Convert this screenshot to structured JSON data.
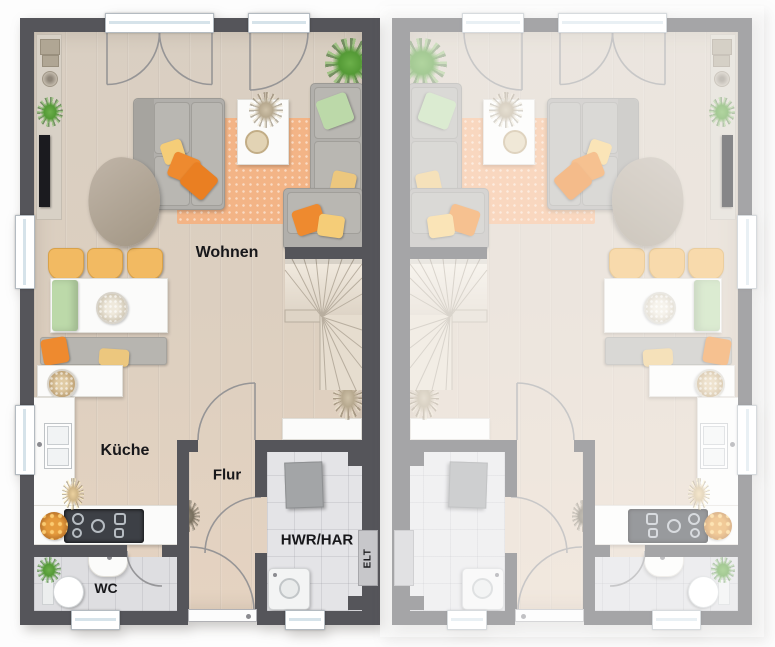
{
  "title": "Erdgeschoss Grundriss Doppelhaus",
  "labels": {
    "living": "Wohnen",
    "kitchen": "Küche",
    "hall": "Flur",
    "wc": "WC",
    "utility": "HWR/HAR",
    "electrical": "ELT"
  },
  "colors": {
    "wall": "#55555a",
    "floor": "#d8cdc0",
    "tile": "#e4e4e7",
    "rug": "#f3b486",
    "pillowOrange": "#ee8a2f",
    "pillowYellow": "#f5cd78",
    "pillowGreen": "#bcd9a9",
    "chair": "#f2ba62",
    "counter": "#f7f7f6",
    "sofa": "#b0aeaa",
    "stairs": "#ece4d7",
    "applianceGray": "#a3a5a7"
  }
}
